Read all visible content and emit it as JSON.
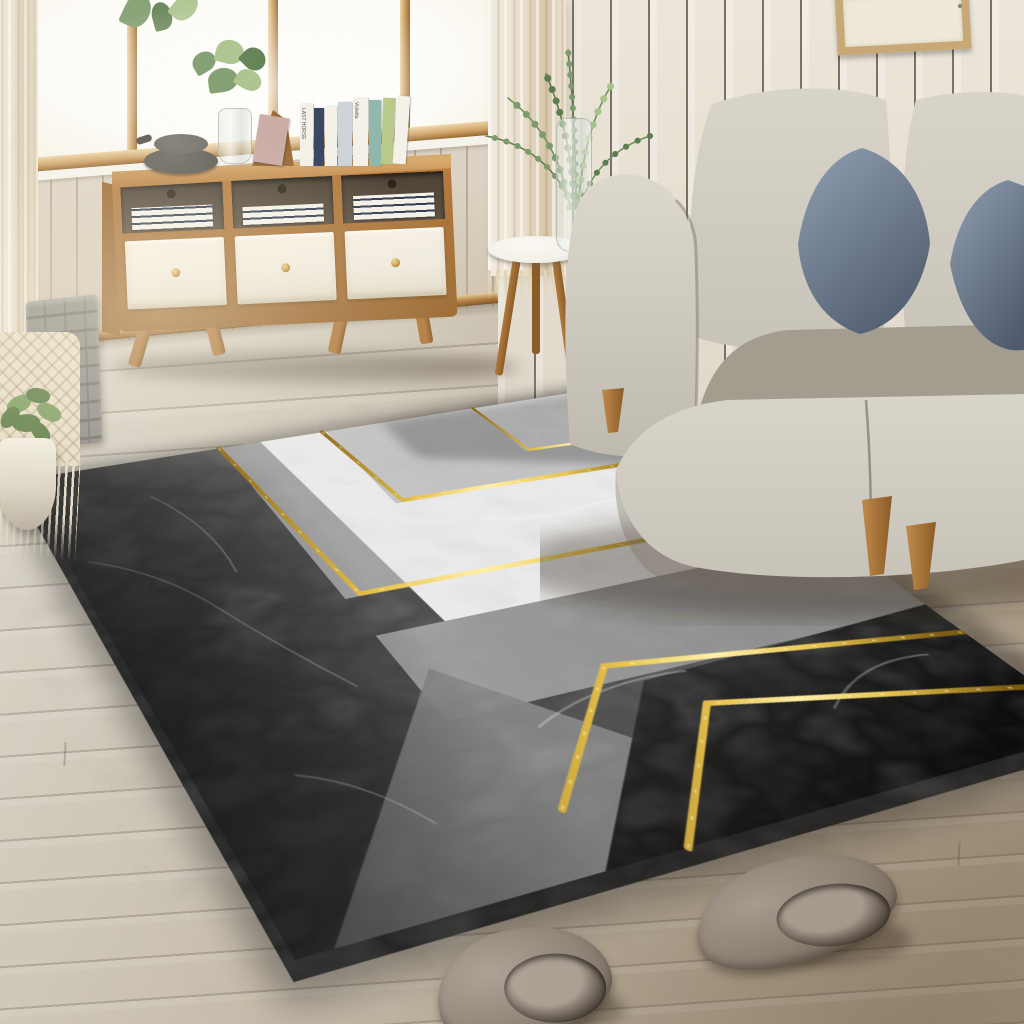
{
  "meta": {
    "scene_type": "living room interior product photograph",
    "product": "geometric marble-pattern area rug with gold accent lines"
  },
  "cabinet": {
    "book_spine_labels": [
      "LAST HORSE",
      "Violetta"
    ]
  },
  "objects": [
    {
      "name": "window",
      "desc": "bright window with tan wood frame"
    },
    {
      "name": "plank-wall",
      "desc": "whitewashed vertical plank walls"
    },
    {
      "name": "sheer-curtains",
      "desc": "beige sheer curtains with fringe"
    },
    {
      "name": "sideboard",
      "desc": "wood sideboard, white drawers, splayed legs"
    },
    {
      "name": "decor-books",
      "desc": "books, bowls and eucalyptus vase on sideboard"
    },
    {
      "name": "side-table",
      "desc": "round white tripod side table with glass vase"
    },
    {
      "name": "sofa",
      "desc": "light gray fabric sofa with blue pillows, wood legs"
    },
    {
      "name": "rug",
      "desc": "gray/white/black marble rug with gold chevron lines"
    },
    {
      "name": "basket",
      "desc": "felt basket with macrame hanging and potted plant"
    },
    {
      "name": "slippers",
      "desc": "pair of plush taupe slippers"
    },
    {
      "name": "picture-frame",
      "desc": "wood picture frame on wall"
    },
    {
      "name": "floor",
      "desc": "light wood laminate floor"
    }
  ],
  "palette": {
    "wall_left_plank": "#dbd2c3",
    "wall_left_gap": "#b9ab97",
    "wall_left_low": "#cdbfa9",
    "window_glass": "#fdfcf8",
    "window_glow": "#f6efdf",
    "frame_wood": "#cfa268",
    "frame_wood_dark": "#96682f",
    "frame_wood_hi": "#ecd4a4",
    "sill_white": "#f6f3ec",
    "wall_right": "#ece6da",
    "wall_right_gap": "#7a7165",
    "wall_right_shade": "#ddd5c6",
    "pic_frame": "#c9a878",
    "pic_inner": "#efe8d6",
    "curtain_base": "#e9decb",
    "curtain_fold": "#d6c5a8",
    "curtain_fringe": "#e2d6ba",
    "floor_mid": "#c6bcae",
    "cab_wood": "#b67c3f",
    "cab_wood_dark": "#9a6730",
    "cab_wood_hi": "#d9aa6d",
    "cab_white": "#efeade",
    "cab_inset": "#5d5040",
    "knob": "#c99f4a",
    "book_white": "#f4f1e8",
    "book_pink": "#c9aaa4",
    "book_teal": "#8fb7ac",
    "book_green": "#b9c98b",
    "book_navy": "#35425e",
    "book_blue": "#ccd4d8",
    "bowl_dark": "#57554f",
    "bowl_mid": "#6c6a64",
    "leaf_dark": "#5e7d4f",
    "leaf_mid": "#7d9a6b",
    "leaf_light": "#a9c28b",
    "table_top": "#f4f1ea",
    "sofa_fabric": "#c8c3b8",
    "sofa_hi": "#d8d4c9",
    "sofa_shadow": "#a39d90",
    "pillow": "#6a7789",
    "pillow_hi": "#8b99ac",
    "pillow_dark": "#505c6e",
    "leg_wood": "#b07a3e",
    "leg_wood_dark": "#8a5c28",
    "rug_base": "#a3a3a3",
    "rug_dark_hi": "#757575",
    "rug_dark_lo": "#3e3e3e",
    "rug_black_hi": "#343434",
    "rug_black_lo": "#0a0a0a",
    "rug_white": "#ebebeb",
    "rug_white2": "#e0e0e0",
    "rug_gray_band": "#969696",
    "rug_gray_tri": "#858585",
    "rug_light_zone": "#c3c3c3",
    "rug_side": "#262626",
    "vein": "#ffffff",
    "gold_deep": "#8a6518",
    "gold_mid": "#e8c44d",
    "gold_hi": "#fff0a8",
    "gold_dark": "#7d5c14",
    "slipper_body": "#968b7f",
    "slipper_hi": "#b3a89c",
    "slipper_dark": "#6e6358",
    "slipper_open": "#3a332c",
    "slipper_sole": "#b4a99d",
    "felt": "#8f8c86",
    "felt_dark": "#747169",
    "macrame": "#e7ddc5",
    "pot": "#ece7da",
    "plant": "#5d7c43",
    "plant_hi": "#7f9d60"
  }
}
